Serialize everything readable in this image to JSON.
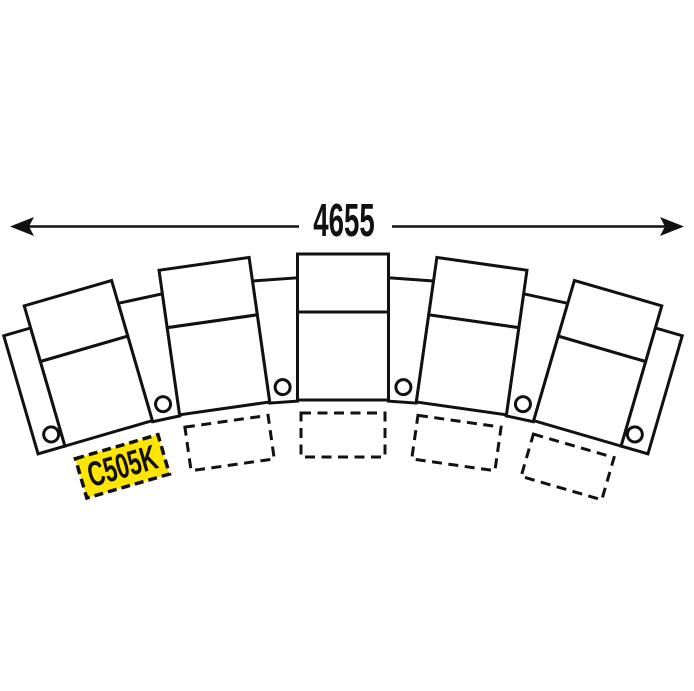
{
  "page": {
    "background": "#ffffff"
  },
  "diagram": {
    "type": "curved-theater-seating-row",
    "seat_count": 5,
    "cupholder_count": 6,
    "footprint_count": 4,
    "dimension": {
      "label": "4655"
    },
    "model_label": {
      "text": "C505K",
      "background_color": "#FFE600",
      "text_color": "#111111",
      "border_color": "#111111"
    },
    "colors": {
      "line": "#111111",
      "fill": "#ffffff"
    },
    "geometry": {
      "canvas": {
        "w": 694,
        "h": 691
      },
      "arc_center": {
        "x": 343,
        "y": 1240
      },
      "seat": {
        "half_width": 45.5,
        "back_top_y": 254,
        "divider_y": 312,
        "bottom_y": 400,
        "angles_deg": [
          -16.2,
          -8.1,
          0,
          8.1,
          16.2
        ]
      },
      "armrest": {
        "inner_angles_deg": [
          -12.15,
          -4.05,
          4.05,
          12.15
        ],
        "top_y": 277,
        "bottom_y": 400,
        "top_half_width": 22.6,
        "bottom_half_width": 13.9,
        "end_width": 28,
        "cup_y": 385,
        "cup_r": 7.5,
        "cup_edge_offset": 10
      },
      "footprint": {
        "x_offset": -42,
        "y": 413,
        "w": 84,
        "h": 44,
        "dash": "10 6.5",
        "seat_indices": [
          1,
          2,
          3,
          4
        ]
      },
      "label_box": {
        "x_offset": -39,
        "y": 415,
        "w": 86,
        "h": 41,
        "dash": "9 5",
        "seat_index": 0,
        "font_size": 35,
        "scale_x": 0.65,
        "baseline_y": 447
      },
      "arrow": {
        "y": 226.5,
        "x1": 10,
        "x2": 684,
        "gap": [
          299,
          392
        ],
        "head_len": 24,
        "head_half_width": 9.5,
        "stroke_width": 2.6,
        "font_size": 46,
        "scale_x": 0.6,
        "text_x": 344,
        "baseline_y": 236
      },
      "stroke_width": 3
    }
  }
}
